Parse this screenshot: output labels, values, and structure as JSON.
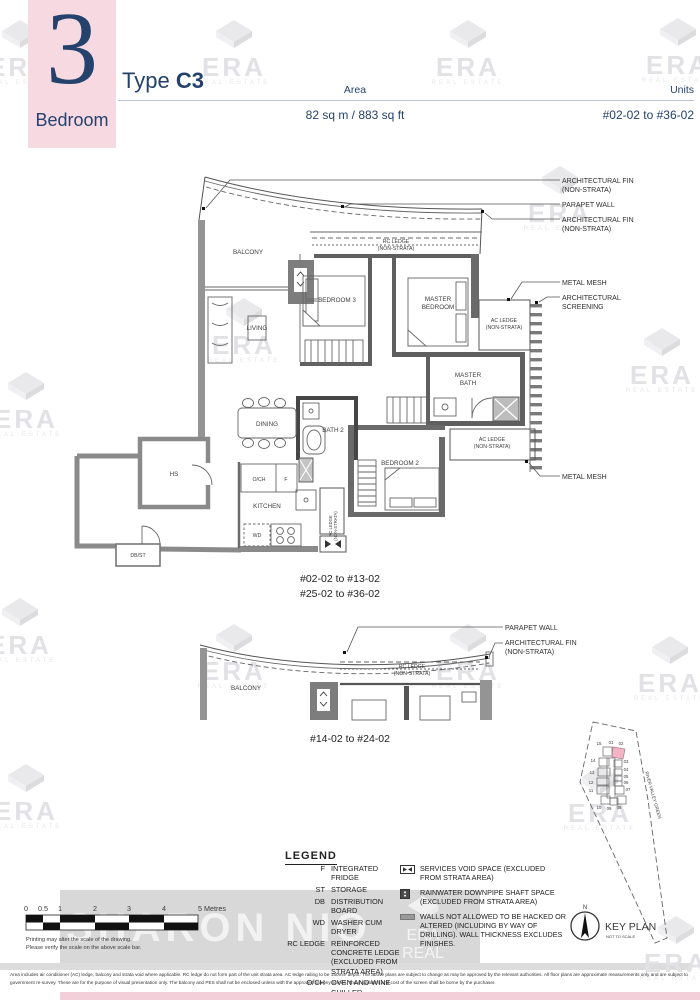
{
  "header": {
    "bedroom_count": "3",
    "bedroom_label": "Bedroom",
    "type_prefix": "Type",
    "type_value": "C3",
    "area_label": "Area",
    "area_value": "82 sq m / 883 sq ft",
    "units_label": "Units",
    "units_value": "#02-02 to #36-02"
  },
  "watermark": {
    "brand": "ERA",
    "tagline": "REAL ESTATE",
    "agent": "SHARON NIO"
  },
  "main_plan": {
    "rooms": {
      "balcony": "BALCONY",
      "rc_ledge_1": "RC LEDGE",
      "rc_ledge_2": "(NON-STRATA)",
      "bedroom3": "BEDROOM 3",
      "master_bedroom_1": "MASTER",
      "master_bedroom_2": "BEDROOM",
      "living": "LIVING",
      "ac_ledge_up_1": "AC LEDGE",
      "ac_ledge_up_2": "(NON-STRATA)",
      "master_bath_1": "MASTER",
      "master_bath_2": "BATH",
      "dining": "DINING",
      "bath2": "BATH 2",
      "hs": "HS",
      "och": "O/CH",
      "fridge": "F",
      "kitchen": "KITCHEN",
      "wd": "WD",
      "rc_ledge_vert_1": "RC LEDGE",
      "rc_ledge_vert_2": "(NON-STRATA)",
      "bedroom2": "BEDROOM 2",
      "dbst": "DB/ST",
      "ac_ledge_low_1": "AC LEDGE",
      "ac_ledge_low_2": "(NON-STRATA)"
    },
    "callouts": {
      "arch_fin_1": "ARCHITECTURAL FIN",
      "arch_fin_2": "(NON-STRATA)",
      "parapet": "PARAPET WALL",
      "metal_mesh": "METAL MESH",
      "arch_screen_1": "ARCHITECTURAL",
      "arch_screen_2": "SCREENING"
    },
    "caption_1": "#02-02 to #13-02",
    "caption_2": "#25-02 to #36-02"
  },
  "second_plan": {
    "balcony": "BALCONY",
    "rc_ledge_1": "RC LEDGE",
    "rc_ledge_2": "(NON-STRATA)",
    "callout_parapet": "PARAPET WALL",
    "callout_fin_1": "ARCHITECTURAL FIN",
    "callout_fin_2": "(NON-STRATA)",
    "caption": "#14-02 to #24-02"
  },
  "legend": {
    "title": "LEGEND",
    "abbreviations": [
      {
        "abbr": "F",
        "desc": "INTEGRATED FRIDGE"
      },
      {
        "abbr": "ST",
        "desc": "STORAGE"
      },
      {
        "abbr": "DB",
        "desc": "DISTRIBUTION BOARD"
      },
      {
        "abbr": "WD",
        "desc": "WASHER CUM DRYER"
      },
      {
        "abbr": "RC LEDGE",
        "desc": "REINFORCED CONCRETE LEDGE (EXCLUDED FROM STRATA AREA)"
      },
      {
        "abbr": "O/CH",
        "desc": "OVEN AND WINE CHILLER"
      }
    ],
    "symbols": [
      {
        "icon": "services-void-icon",
        "desc": "SERVICES VOID SPACE (EXCLUDED FROM STRATA AREA)"
      },
      {
        "icon": "rainwater-downpipe-icon",
        "desc": "RAINWATER DOWNPIPE SHAFT SPACE (EXCLUDED FROM STRATA AREA)"
      },
      {
        "icon": "restricted-wall-icon",
        "desc": "WALLS NOT ALLOWED TO BE HACKED OR ALTERED (INCLUDING BY WAY OF DRILLING). WALL THICKNESS EXCLUDES FINISHES."
      }
    ]
  },
  "scale_bar": {
    "labels": [
      "0",
      "0.5",
      "1",
      "2",
      "3",
      "4",
      "5 Metres"
    ],
    "note_1": "Printing may alter the scale of the drawing.",
    "note_2": "Please verify the scale on the above scale bar."
  },
  "key_plan": {
    "title": "KEY PLAN",
    "subtitle": "NOT TO SCALE",
    "compass_label": "N",
    "street": "RIVER VALLEY GREEN",
    "highlighted_stack": "02",
    "stacks": [
      "15",
      "01",
      "02",
      "14",
      "03",
      "13",
      "04",
      "12",
      "05",
      "06",
      "11",
      "07",
      "10",
      "09",
      "08"
    ]
  },
  "disclaimer": "Area includes air conditioner (AC) ledge, balcony and strata void where applicable. RC ledge do not form part of the unit strata area. AC ledge railing to be 150mm depth. The above plans are subject to change as may be approved by the relevant authorities. All floor plans are approximate measurements only and are subject to government re-survey. These are for the purpose of visual presentation only. The balcony and PES shall not be enclosed unless with the approved balcony screen. The installation and cost of the screen shall be borne by the purchaser.",
  "colors": {
    "navy": "#24426c",
    "pink": "#f7d9e2",
    "pinkbar": "#f3cfd9",
    "keyplan_highlight": "#f2b4c5"
  }
}
